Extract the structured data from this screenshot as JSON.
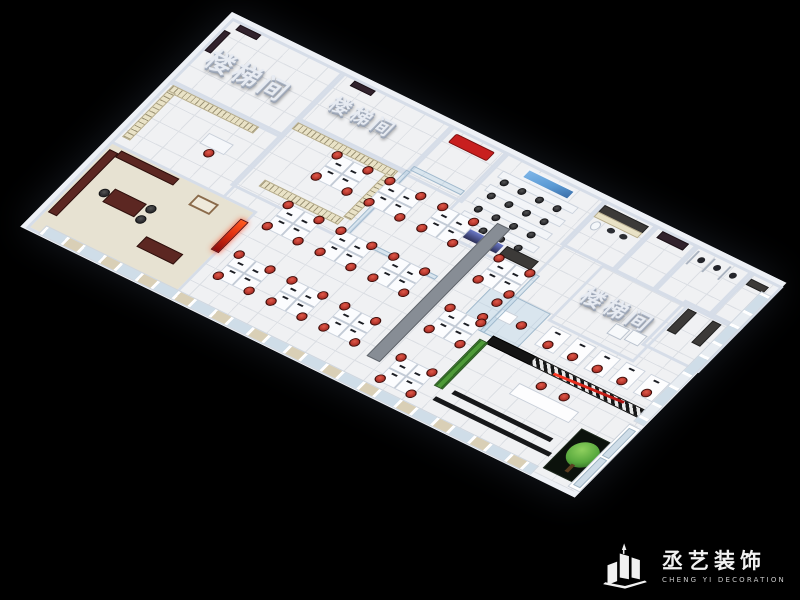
{
  "scene": {
    "background": "#000000"
  },
  "floorplan": {
    "stairwell_label": "楼梯间",
    "colors": {
      "wall": "#d6dde8",
      "wall_top": "#eef1f6",
      "floor": "#f0f1f3",
      "tile_line": "#dcdfe4",
      "chair_red": "#b2332a",
      "sofa_red": "#c81f1f",
      "sign_red": "#e03010",
      "screen_blue": "#5b9bd5",
      "mahogany": "#5c2722",
      "divider_gray": "#878d95",
      "plant_green": "#4e9a38",
      "tree_green": "#57a83d",
      "shelf_beige": "#e9e2c6",
      "counter_dark": "#3c3a38",
      "feature_dark": "#141414",
      "glass": "#cfdde8",
      "curtain": "#d9cfb6",
      "mat_dark": "#17181a",
      "carpet": "#e7e2d2"
    }
  },
  "watermark": {
    "brand_cn": "丞艺装饰",
    "brand_en": "CHENG YI DECORATION"
  }
}
